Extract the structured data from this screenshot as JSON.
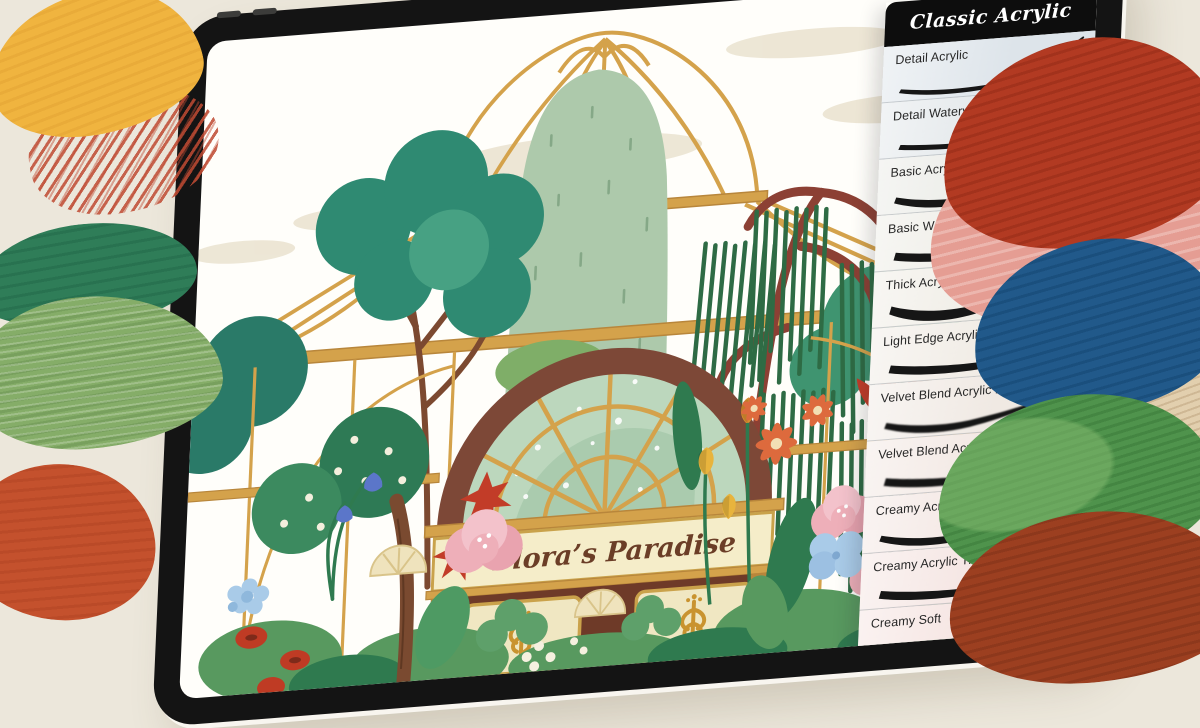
{
  "page": {
    "background": "#ece7db"
  },
  "tablet": {
    "bezel_color": "#141414",
    "camera_dot_count": 2
  },
  "canvas": {
    "sign_text": "Flora’s Paradise"
  },
  "brush_panel": {
    "title": "Classic Acrylic",
    "title_bg": "#0d0d0d",
    "title_color": "#ffffff",
    "brushes": [
      {
        "label": "Detail Acrylic",
        "tint": "#dde4ea"
      },
      {
        "label": "Detail Watery Acrylic",
        "tint": "#e1e6e9"
      },
      {
        "label": "Basic Acrylic",
        "tint": "#e9eae5"
      },
      {
        "label": "Basic Watery Acrylic",
        "tint": "#edece5"
      },
      {
        "label": "Thick Acrylic",
        "tint": "#efece4"
      },
      {
        "label": "Light Edge Acrylic",
        "tint": "#f0ebe4"
      },
      {
        "label": "Velvet Blend Acrylic 1",
        "tint": "#f0e9e3"
      },
      {
        "label": "Velvet Blend Acrylic 2",
        "tint": "#f2e7e2"
      },
      {
        "label": "Creamy Acrylic Trace 1",
        "tint": "#f3e6e2"
      },
      {
        "label": "Creamy Acrylic Trace 2",
        "tint": "#f4e4e1"
      },
      {
        "label": "Creamy Soft",
        "tint": "#f5e3e0"
      }
    ]
  },
  "paint_swatches": [
    {
      "name": "red-crayon-hatch",
      "color": "#bf4a32"
    },
    {
      "name": "yellow-smear",
      "color": "#f0b43f"
    },
    {
      "name": "dark-green-smear",
      "color": "#2f7d58"
    },
    {
      "name": "sage-green-smear",
      "color": "#85ad68"
    },
    {
      "name": "vermilion-smear",
      "color": "#c4512d"
    },
    {
      "name": "pink-smear",
      "color": "#e59d93"
    },
    {
      "name": "red-smear",
      "color": "#b23a22"
    },
    {
      "name": "beige-smear",
      "color": "#e2cfae"
    },
    {
      "name": "blue-smear",
      "color": "#21598a"
    },
    {
      "name": "green-smear",
      "color": "#4f934c"
    },
    {
      "name": "rust-smear",
      "color": "#9c3f20"
    }
  ]
}
